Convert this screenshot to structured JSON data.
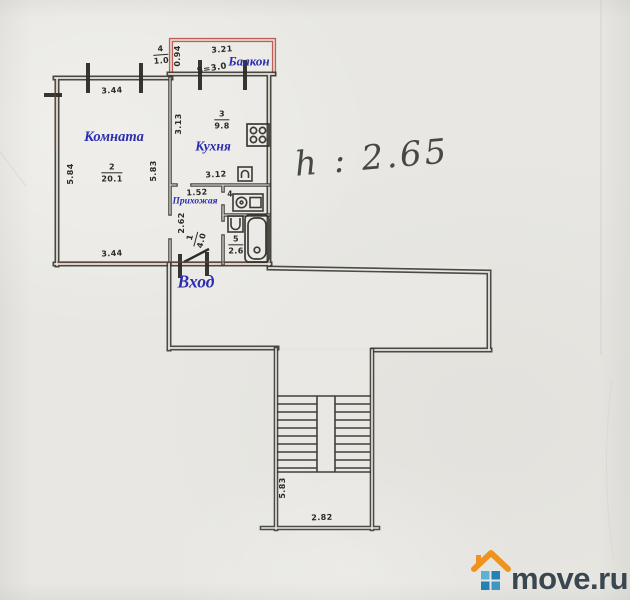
{
  "colors": {
    "paper": "#e8e7e3",
    "wall_ink": "#3b3831",
    "label_blue": "#2b2eae",
    "balcony_red": "#bb4f44",
    "entry_red_brown": "#8a4a3c",
    "handwriting": "#474745",
    "logo_orange": "#f0921e",
    "logo_blue_dark": "#2282b4",
    "logo_blue_light": "#5fb0d5",
    "logo_text": "#3a4650"
  },
  "plan": {
    "ceiling_note": "h : 2.65",
    "labels": {
      "room": "Комната",
      "kitchen": "Кухня",
      "balcony": "Балкон",
      "hallway": "Прихожая",
      "entrance": "Вход"
    },
    "room_stats": {
      "living": {
        "num": "2",
        "area": "20.1"
      },
      "kitchen": {
        "num": "3",
        "area": "9.8"
      },
      "hallway": {
        "num": "1",
        "area": "4.0"
      },
      "bath": {
        "num": "5",
        "area": "2.6"
      },
      "balcony": {
        "num": "4",
        "area": "1.0"
      },
      "balcony_s": "S=3.0",
      "wc_num": "4"
    },
    "dims": {
      "room_top": "3.44",
      "room_bottom": "3.44",
      "room_left": "5.84",
      "room_right": "5.83",
      "kitchen_left": "3.13",
      "kitchen_bottom": "3.12",
      "balcony_width": "3.21",
      "balcony_depth": "0.94",
      "hall_top": "1.52",
      "hall_left": "2.62",
      "stair_height": "5.83",
      "stair_width": "2.82"
    }
  },
  "icons": {
    "stove": "stove-icon",
    "kitchen_sink": "sink-icon",
    "boiler": "boiler-icon",
    "washbasin": "washbasin-icon",
    "bathtub": "bathtub-icon",
    "entrance_door": "door-swing-icon",
    "stairs": "staircase-icon",
    "windows": "window-tick-icon",
    "logo_house": "house-icon"
  },
  "logo": {
    "text": "move.ru"
  }
}
